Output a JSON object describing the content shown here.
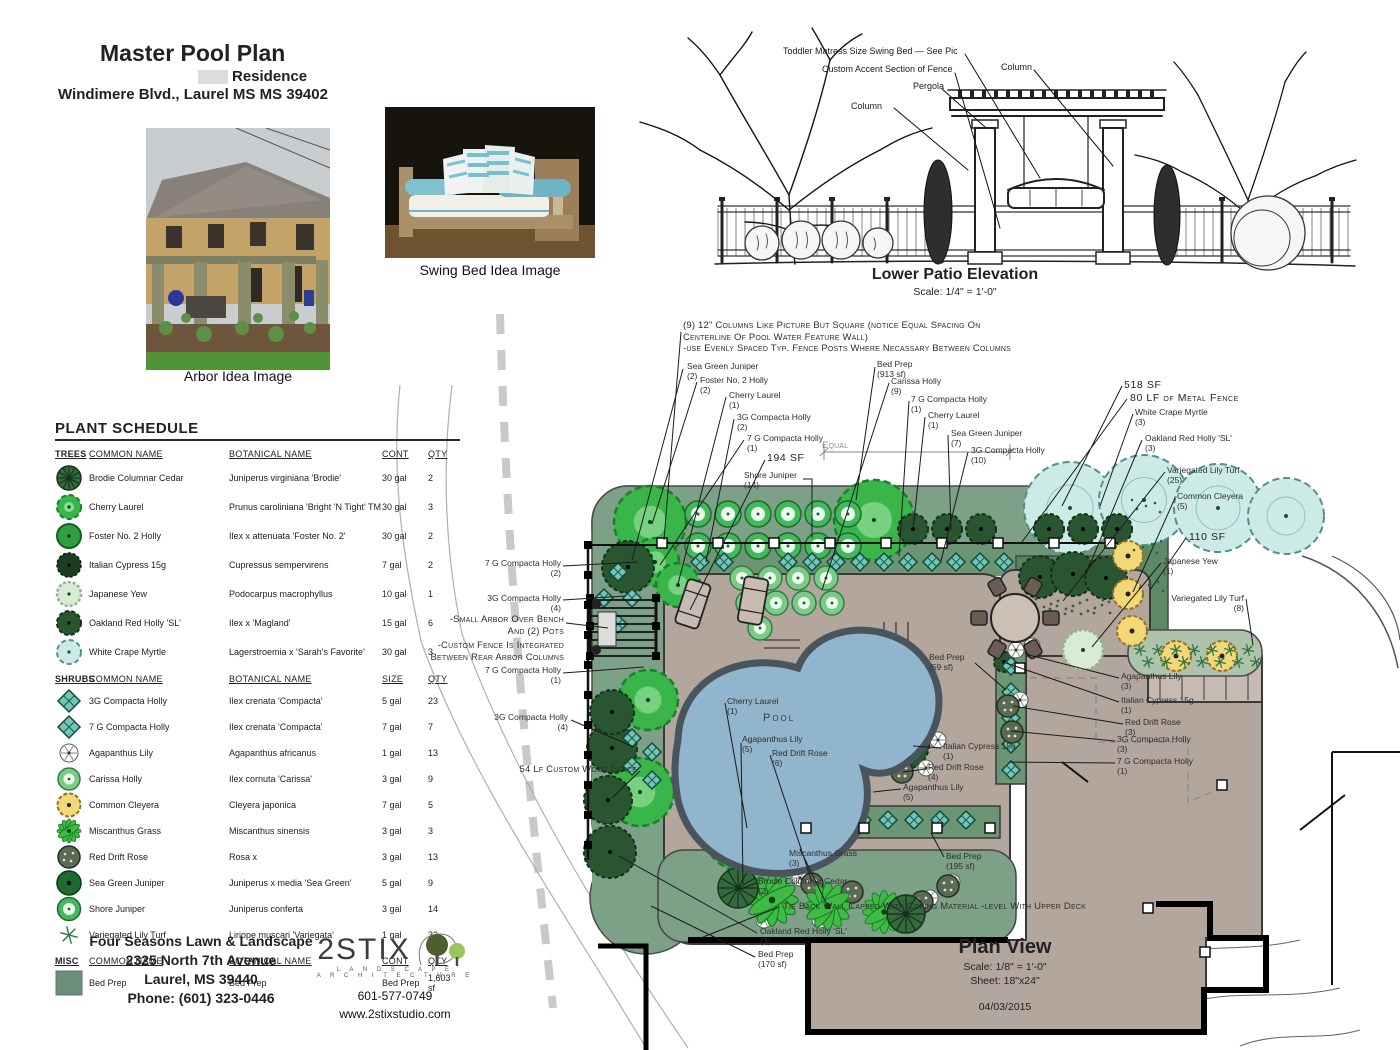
{
  "header": {
    "title": "Master Pool Plan",
    "subtitle": "Residence",
    "address": "Windimere Blvd., Laurel MS MS 39402"
  },
  "photos": {
    "arbor_caption": "Arbor Idea Image",
    "swing_caption": "Swing Bed Idea Image"
  },
  "elevation": {
    "title": "Lower Patio Elevation",
    "scale": "Scale: 1/4\" = 1'-0\"",
    "labels": [
      {
        "text": "Toddler Matress Size Swing Bed — See Pic",
        "x": 783,
        "y": 46
      },
      {
        "text": "Custom Accent Section of Fence",
        "x": 822,
        "y": 64
      },
      {
        "text": "Pergola",
        "x": 913,
        "y": 81
      },
      {
        "text": "Column",
        "x": 851,
        "y": 101
      },
      {
        "text": "Column",
        "x": 1001,
        "y": 62
      }
    ]
  },
  "schedule": {
    "title": "PLANT SCHEDULE",
    "sections": [
      {
        "heading": "TREES",
        "columns": [
          "COMMON NAME",
          "BOTANICAL NAME",
          "CONT",
          "QTY"
        ],
        "row_class": "tree",
        "rows": [
          {
            "icon": "brodie-cedar-icon",
            "common": "Brodie Columnar Cedar",
            "botanical": "Juniperus virginiana 'Brodie'",
            "cont": "30 gal",
            "qty": "2"
          },
          {
            "icon": "cherry-laurel-icon",
            "common": "Cherry Laurel",
            "botanical": "Prunus caroliniana 'Bright 'N Tight' TM",
            "cont": "30 gal",
            "qty": "3"
          },
          {
            "icon": "foster-holly-icon",
            "common": "Foster No. 2 Holly",
            "botanical": "Ilex x attenuata 'Foster No. 2'",
            "cont": "30 gal",
            "qty": "2"
          },
          {
            "icon": "italian-cypress-icon",
            "common": "Italian Cypress 15g",
            "botanical": "Cupressus sempervirens",
            "cont": "7 gal",
            "qty": "2"
          },
          {
            "icon": "japanese-yew-icon",
            "common": "Japanese Yew",
            "botanical": "Podocarpus macrophyllus",
            "cont": "10 gal",
            "qty": "1"
          },
          {
            "icon": "oakland-holly-icon",
            "common": "Oakland Red Holly 'SL'",
            "botanical": "Ilex x 'Magland'",
            "cont": "15 gal",
            "qty": "6"
          },
          {
            "icon": "crape-myrtle-icon",
            "common": "White Crape Myrtle",
            "botanical": "Lagerstroemia x 'Sarah's Favorite'",
            "cont": "30 gal",
            "qty": "3"
          }
        ]
      },
      {
        "heading": "SHRUBS",
        "columns": [
          "COMMON NAME",
          "BOTANICAL NAME",
          "SIZE",
          "QTY"
        ],
        "row_class": "shrub",
        "rows": [
          {
            "icon": "compacta-holly-icon",
            "common": "3G Compacta Holly",
            "botanical": "Ilex crenata 'Compacta'",
            "cont": "5 gal",
            "qty": "23"
          },
          {
            "icon": "compacta-holly-icon",
            "common": "7 G Compacta Holly",
            "botanical": "Ilex crenata 'Compacta'",
            "cont": "7 gal",
            "qty": "7"
          },
          {
            "icon": "agapanthus-icon",
            "common": "Agapanthus Lily",
            "botanical": "Agapanthus africanus",
            "cont": "1 gal",
            "qty": "13"
          },
          {
            "icon": "carissa-holly-icon",
            "common": "Carissa Holly",
            "botanical": "Ilex cornuta 'Carissa'",
            "cont": "3 gal",
            "qty": "9"
          },
          {
            "icon": "cleyera-icon",
            "common": "Common Cleyera",
            "botanical": "Cleyera japonica",
            "cont": "7 gal",
            "qty": "5"
          },
          {
            "icon": "miscanthus-icon",
            "common": "Miscanthus Grass",
            "botanical": "Miscanthus sinensis",
            "cont": "3 gal",
            "qty": "3"
          },
          {
            "icon": "red-drift-rose-icon",
            "common": "Red Drift Rose",
            "botanical": "Rosa x",
            "cont": "3 gal",
            "qty": "13"
          },
          {
            "icon": "sea-green-juniper-icon",
            "common": "Sea Green Juniper",
            "botanical": "Juniperus x media 'Sea Green'",
            "cont": "5 gal",
            "qty": "9"
          },
          {
            "icon": "shore-juniper-icon",
            "common": "Shore Juniper",
            "botanical": "Juniperus conferta",
            "cont": "3 gal",
            "qty": "14"
          },
          {
            "icon": "lily-turf-icon",
            "common": "Variegated Lily Turf",
            "botanical": "Liriope muscari 'Variegata'",
            "cont": "1 gal",
            "qty": "33"
          }
        ]
      },
      {
        "heading": "MISC",
        "columns": [
          "COMMON NAME",
          "BOTANICAL NAME",
          "CONT",
          "QTY"
        ],
        "row_class": "misc",
        "rows": [
          {
            "icon": "bed-prep-icon",
            "common": "Bed Prep",
            "botanical": "Bed Prep",
            "cont": "Bed Prep",
            "qty": "1,603 sf"
          }
        ]
      }
    ]
  },
  "plan": {
    "title": "Plan View",
    "scale": "Scale: 1/8\" = 1'-0\"",
    "sheet": "Sheet: 18\"x24\"",
    "date": "04/03/2015",
    "annotations": [
      {
        "text": "(9) 12\" Columns Like Picture But Square (notice Equal Spacing On\nCenterline Of Pool Water Feature Wall)\n-use Evenly Spaced Typ. Fence Posts Where Necassary Between  Columns",
        "x": 683,
        "y": 320,
        "cls": "caps"
      },
      {
        "text": "Sea Green Juniper\n(2)",
        "x": 687,
        "y": 361
      },
      {
        "text": "Foster No. 2 Holly\n(2)",
        "x": 700,
        "y": 375
      },
      {
        "text": "Cherry Laurel\n(1)",
        "x": 729,
        "y": 390
      },
      {
        "text": "3G Compacta Holly\n(2)",
        "x": 737,
        "y": 412
      },
      {
        "text": "7 G Compacta Holly\n(1)",
        "x": 747,
        "y": 433
      },
      {
        "text": "194 SF",
        "x": 767,
        "y": 452,
        "cls": "sf"
      },
      {
        "text": "Shore Juniper\n(14)",
        "x": 744,
        "y": 470
      },
      {
        "text": "Equal",
        "x": 822,
        "y": 440,
        "cls": "gray caps"
      },
      {
        "text": "Bed Prep\n(913 sf)",
        "x": 877,
        "y": 359
      },
      {
        "text": "Carissa Holly\n(9)",
        "x": 891,
        "y": 376
      },
      {
        "text": "7 G Compacta Holly\n(1)",
        "x": 911,
        "y": 394
      },
      {
        "text": "Cherry Laurel\n(1)",
        "x": 928,
        "y": 410
      },
      {
        "text": "Sea Green Juniper\n(7)",
        "x": 951,
        "y": 428
      },
      {
        "text": "3G Compacta Holly\n(10)",
        "x": 971,
        "y": 445
      },
      {
        "text": "518 SF",
        "x": 1124,
        "y": 379,
        "cls": "sf"
      },
      {
        "text": "80 LF of Metal Fence",
        "x": 1130,
        "y": 392,
        "cls": "sf"
      },
      {
        "text": "White Crape Myrtle\n(3)",
        "x": 1135,
        "y": 407
      },
      {
        "text": "Oakland Red Holly 'SL'\n(3)",
        "x": 1145,
        "y": 433
      },
      {
        "text": "Variegated Lily Turf\n(25)",
        "x": 1167,
        "y": 465
      },
      {
        "text": "Common Cleyera\n(5)",
        "x": 1177,
        "y": 491
      },
      {
        "text": "110 SF",
        "x": 1189,
        "y": 531,
        "cls": "sf"
      },
      {
        "text": "Japanese Yew\n(1)",
        "x": 1163,
        "y": 556
      },
      {
        "text": "Variegated Lily Turf\n(8)",
        "x": 1244,
        "y": 593,
        "cls": "right"
      },
      {
        "text": "7 G Compacta Holly\n(2)",
        "x": 561,
        "y": 558,
        "cls": "right"
      },
      {
        "text": "3G Compacta Holly\n(4)",
        "x": 561,
        "y": 593,
        "cls": "right"
      },
      {
        "text": "-Small Arbor Over Bench\nAnd (2) Pots",
        "x": 564,
        "y": 614,
        "cls": "caps right"
      },
      {
        "text": "-Custom Fence Is Integrated\nBetween Rear Arbor Columns",
        "x": 564,
        "y": 640,
        "cls": "caps right"
      },
      {
        "text": "7 G Compacta Holly\n(1)",
        "x": 561,
        "y": 665,
        "cls": "right"
      },
      {
        "text": "3G Compacta Holly\n(4)",
        "x": 568,
        "y": 712,
        "cls": "right"
      },
      {
        "text": "54 Lf Custom Wood Fence",
        "x": 637,
        "y": 764,
        "cls": "caps right"
      },
      {
        "text": "Cherry Laurel\n(1)",
        "x": 727,
        "y": 696
      },
      {
        "text": "Pool",
        "x": 763,
        "y": 712,
        "cls": "pool"
      },
      {
        "text": "Agapanthus Lily\n(5)",
        "x": 742,
        "y": 734
      },
      {
        "text": "Red Drift Rose\n(6)",
        "x": 772,
        "y": 748
      },
      {
        "text": "Italian Cypress 15g\n(1)",
        "x": 943,
        "y": 741
      },
      {
        "text": "Red Drift Rose\n(4)",
        "x": 928,
        "y": 762
      },
      {
        "text": "Agapanthus Lily\n(5)",
        "x": 903,
        "y": 782
      },
      {
        "text": "Miscanthus Grass\n(3)",
        "x": 789,
        "y": 848
      },
      {
        "text": "Bed Prep\n(59 sf)",
        "x": 929,
        "y": 652
      },
      {
        "text": "Agapanthus Lily\n(3)",
        "x": 1121,
        "y": 671
      },
      {
        "text": "Italian Cypress 15g\n(1)",
        "x": 1121,
        "y": 695
      },
      {
        "text": "Red Drift Rose\n(3)",
        "x": 1125,
        "y": 717
      },
      {
        "text": "3G Compacta Holly\n(3)",
        "x": 1117,
        "y": 734
      },
      {
        "text": "7 G Compacta Holly\n(1)",
        "x": 1117,
        "y": 756
      },
      {
        "text": "Bed Prep\n(195 sf)",
        "x": 946,
        "y": 851
      },
      {
        "text": "Brodie Columnar Cedar\n(2)",
        "x": 758,
        "y": 876
      },
      {
        "text": "Tie Back Wall Capped With Coping Material -level With Upper Deck",
        "x": 783,
        "y": 901,
        "cls": "caps"
      },
      {
        "text": "Oakland Red Holly 'SL'\n(3)",
        "x": 760,
        "y": 926
      },
      {
        "text": "Bed Prep\n(170 sf)",
        "x": 758,
        "y": 949
      }
    ]
  },
  "footer": {
    "company": "Four Seasons Lawn & Landscape",
    "address1": "2325 North 7th Avenue",
    "address2": "Laurel, MS 39440",
    "phone": "Phone: (601) 323-0446"
  },
  "logo": {
    "name": "2STIX",
    "sub1": "L A N D S C A P E",
    "sub2": "A R C H I T E C T U R E",
    "phone": "601-577-0749",
    "website": "www.2stixstudio.com"
  },
  "colors": {
    "bed_green": "#7ca186",
    "bed_dark": "#6b9573",
    "bed_pale": "#aec3ab",
    "pool_blue": "#90b5cd",
    "deck_taupe": "#b3a69c",
    "myrtle_teal": "#cdebe6",
    "cleyera_yellow": "#f3d878",
    "bright_green": "#3ab54a"
  }
}
